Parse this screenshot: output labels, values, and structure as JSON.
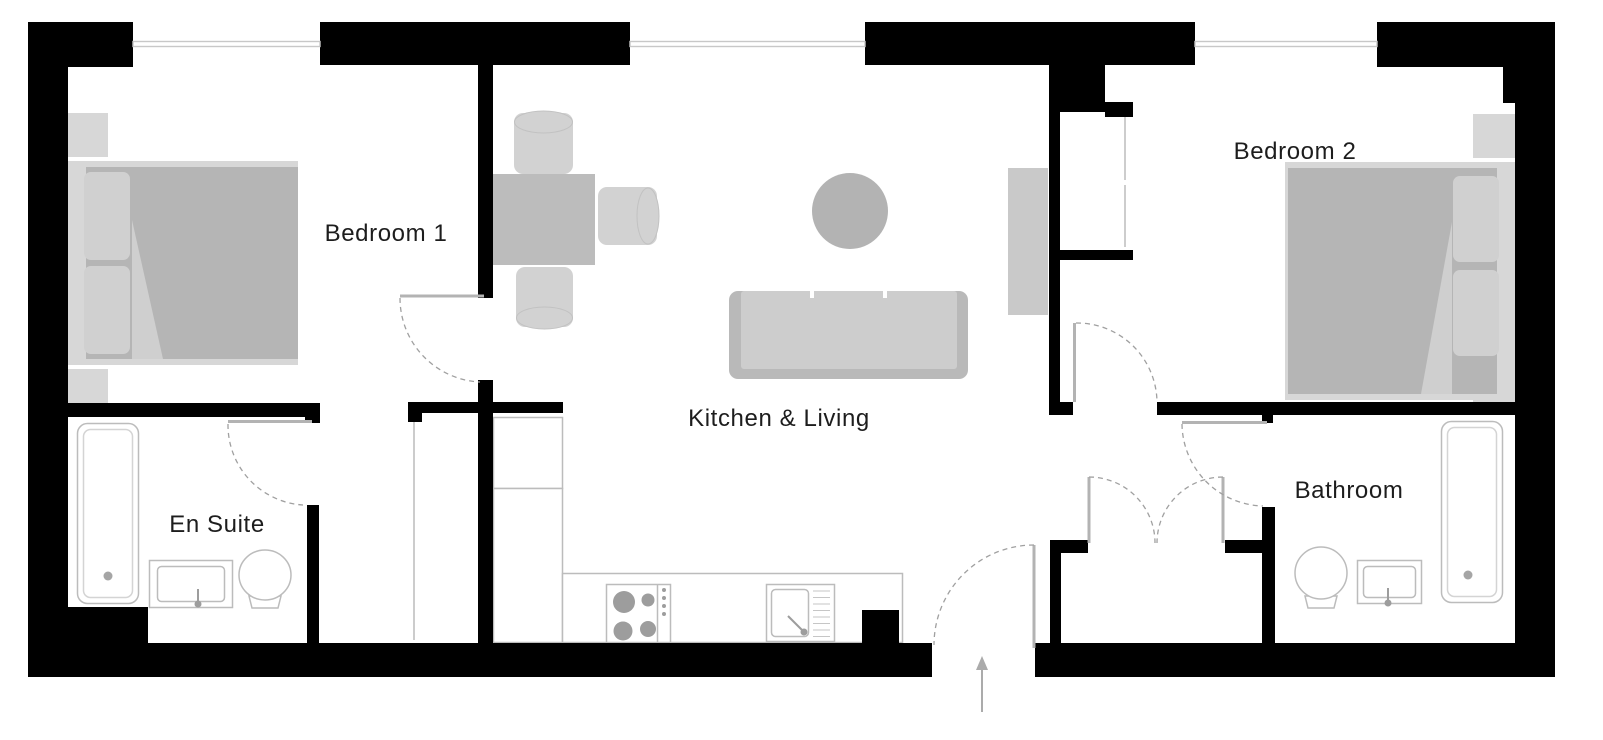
{
  "plan": {
    "type": "apartment-floor-plan",
    "rooms": [
      {
        "id": "bedroom-1",
        "label": "Bedroom 1",
        "fixtures": [
          "double-bed-icon",
          "nightstand-icon",
          "nightstand-icon",
          "wardrobe-icon",
          "door-swing-icon"
        ]
      },
      {
        "id": "bedroom-2",
        "label": "Bedroom 2",
        "fixtures": [
          "double-bed-icon",
          "nightstand-icon",
          "nightstand-icon",
          "built-in-closet-icon",
          "door-swing-icon"
        ]
      },
      {
        "id": "kitchen-living",
        "label": "Kitchen & Living",
        "fixtures": [
          "dining-table-icon",
          "dining-chair-icon",
          "dining-chair-icon",
          "dining-chair-icon",
          "sofa-icon",
          "coffee-table-icon",
          "sideboard-icon",
          "kitchen-counter-icon",
          "fridge-icon",
          "hob-icon",
          "kitchen-sink-icon"
        ]
      },
      {
        "id": "en-suite",
        "label": "En Suite",
        "fixtures": [
          "bathtub-icon",
          "washbasin-icon",
          "toilet-icon",
          "door-swing-icon"
        ]
      },
      {
        "id": "bathroom",
        "label": "Bathroom",
        "fixtures": [
          "bathtub-icon",
          "washbasin-icon",
          "toilet-icon",
          "door-swing-icon"
        ]
      }
    ],
    "entrance": {
      "symbol": "entrance-arrow-icon",
      "door": "entrance-door-swing-icon"
    },
    "hall": {
      "fixtures": [
        "double-door-closet-icon"
      ]
    },
    "window_count": 3,
    "colors": {
      "wall": "#000000",
      "fixture_outline": "#bcbcbc",
      "fixture_inner": "#d2d2d2",
      "furniture_light": "#d7d7d7",
      "furniture_mid": "#b5b5b5",
      "furniture_soft": "#d0d0d0",
      "sofa_frame": "#b9b9b9",
      "sofa_seat": "#cdcdcd",
      "table_gray": "#bcbcbc",
      "coffee_table": "#b3b3b3",
      "sideboard": "#c9c9c9",
      "burner": "#9d9d9d",
      "door_leaf": "#b3b3b3",
      "door_swing": "#a0a0a0",
      "window": "#c8c8c8",
      "arrow": "#ababab",
      "label_text": "#1d1d1d"
    }
  }
}
